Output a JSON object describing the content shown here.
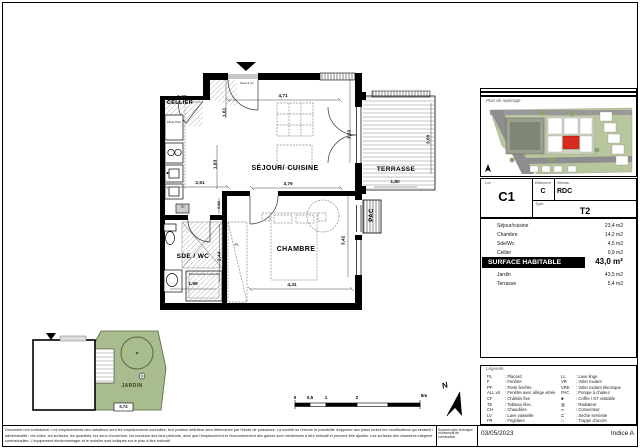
{
  "plan": {
    "rooms": {
      "cellier": "CELLIER",
      "sejour": "SÉJOUR/ CUISINE",
      "chambre": "CHAMBRE",
      "sde_wc": "SDE / WC",
      "terrasse": "TERRASSE",
      "pac": "PAC",
      "jardin": "JARDIN"
    },
    "annotations": {
      "pilote_pac": "Pilote PAC",
      "te": "TE",
      "pl": "PL",
      "seuil_entree": "Seuil 3 cm",
      "seuil_douche": "Seuil douche extra plat",
      "jardin_dim": "5,74"
    },
    "dims": {
      "cellier_w": "1,66",
      "entree_w": "4,71",
      "entree_h": "1,61",
      "cuisine_h": "1,83",
      "cuisine_w": "2,61",
      "sejour_w": "3,76",
      "sejour_window_h": "3,52",
      "couloir_h": "0,66",
      "sde_h": "2,44",
      "sde_w": "1,99",
      "chambre_w": "4,31",
      "chambre_h": "3,42",
      "terrasse_w": "1,80",
      "terrasse_h": "3,00"
    }
  },
  "scalebar": {
    "t0": "0",
    "t1": "0,5",
    "t2": "1",
    "t3": "2",
    "t4": "5m"
  },
  "north_label": "N",
  "panel": {
    "site_plan_title": "Plan de repérage",
    "lot_label": "Lot",
    "lot_value": "C1",
    "batiment_label": "Bâtiment",
    "batiment_value": "C",
    "niveau_label": "Niveau",
    "niveau_value": "RDC",
    "type_label": "Type",
    "type_value": "T2",
    "surfaces": [
      {
        "name": "Séjour/cuisine",
        "area": "23,4 m2"
      },
      {
        "name": "Chambre",
        "area": "14,2 m2"
      },
      {
        "name": "Sde/Wc",
        "area": "4,5 m2"
      },
      {
        "name": "Cellier",
        "area": "0,9 m2"
      }
    ],
    "surface_habitable_label": "SURFACE HABITABLE",
    "surface_habitable_value": "43,0 m²",
    "exterieurs": [
      {
        "name": "Jardin",
        "area": "43,5 m2"
      },
      {
        "name": "Terrasse",
        "area": "5,4 m2"
      }
    ],
    "legend_title": "Légende",
    "legend_left": [
      {
        "abbr": "PL",
        "label": "Placard"
      },
      {
        "abbr": "F",
        "label": "Fenêtre"
      },
      {
        "abbr": "PF",
        "label": "Porte fenêtre"
      },
      {
        "abbr": "ALL.vit",
        "label": "Fenêtre avec allège vitrée"
      },
      {
        "abbr": "CF",
        "label": "Châssis fixe"
      },
      {
        "abbr": "TE",
        "label": "Tableau élec."
      },
      {
        "abbr": "CH",
        "label": "Chaudière"
      },
      {
        "abbr": "LV",
        "label": "Lave vaisselle"
      },
      {
        "abbr": "FR",
        "label": "Frigidaire"
      }
    ],
    "legend_right": [
      {
        "abbr": "LL",
        "label": "Lave linge"
      },
      {
        "abbr": "VR",
        "label": "Volet roulant"
      },
      {
        "abbr": "VRE",
        "label": "Volet roulant électrique"
      },
      {
        "abbr": "PAC",
        "label": "Pompe à chaleur"
      },
      {
        "abbr": "■",
        "label": "Coffre / GT visitable"
      },
      {
        "abbr": "▥",
        "label": "Radiateur"
      },
      {
        "abbr": "═",
        "label": "Convecteur"
      },
      {
        "abbr": "⊏",
        "label": "Sèche serviette"
      },
      {
        "abbr": "□",
        "label": "Trappe d'accès"
      }
    ]
  },
  "footer": {
    "disclaimer_l1": "Document non contractuel. Les emplacements des radiateurs sont les emplacements souhaités, leur position définitive sera déterminée par l'étude de puissance. La société se réserve la possibilité d'apporter aux plans toutes les modifications qui seraient rendues nécessaires par les besoins techniques ou",
    "disclaimer_l2": "administratifs : les côtes, les surfaces, les quantités, les sens d'ouverture, les hauteurs des faux plafonds, ainsi que l'emplacement et l'encombrement des gaines sont mentionnés à titre indicatif et peuvent être ajustés. Les surfaces des chambres intègrent les placards. Les plantations actuelles ne sont pas",
    "disclaimer_l3": "contractuelles. L'équipement électroménager et le mobilier sont indiqués sur le plan à titre indicatif.",
    "note": "Suivant notice technique et descriptif de construction",
    "date": "03/05/2023",
    "indice": "Indice A"
  },
  "colors": {
    "accent_red": "#d92b20",
    "garden_green": "#a9bc8d",
    "site_green": "#b7c69c",
    "road_grey": "#8e8e8e"
  }
}
